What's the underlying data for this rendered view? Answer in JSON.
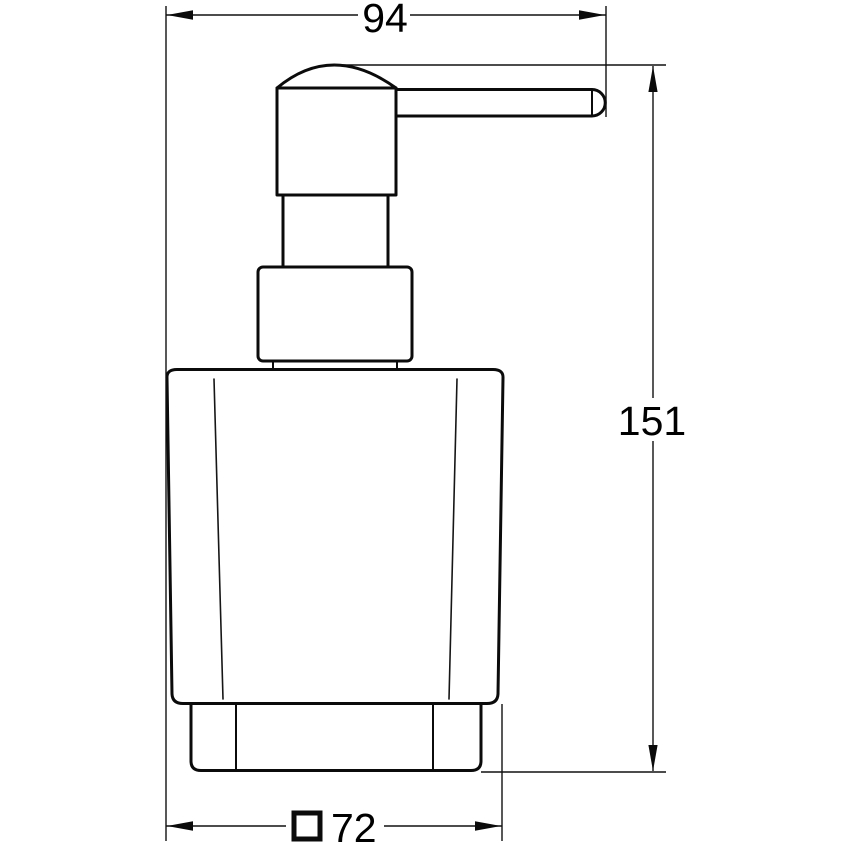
{
  "drawing": {
    "description": "Technical dimension drawing of a soap dispenser with pump head, collar and holder ring (front view)",
    "background_color": "#ffffff",
    "line_color": "#0b0b0b"
  },
  "dimension_labels": {
    "top_width": "94",
    "right_height": "151",
    "bottom_base": "72"
  },
  "icons": {
    "bottom_base_prefix": "square-section-symbol"
  }
}
